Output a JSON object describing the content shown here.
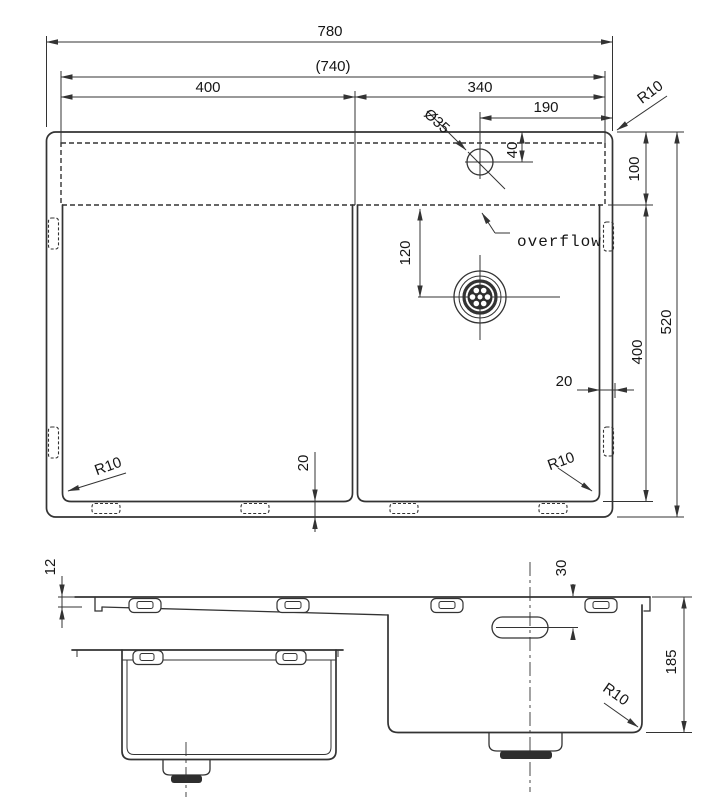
{
  "drawing": {
    "type": "sink technical drawing, plan view and sectional elevation",
    "plan": {
      "width_overall": "780",
      "width_cutout": "(740)",
      "width_left_bowl": "400",
      "width_right_bowl": "340",
      "faucet_from_right": "190",
      "faucet_hole_diameter": "Ø35",
      "faucet_from_top": "40",
      "ledge_height": "100",
      "bowl_height": "400",
      "height_overall": "520",
      "drain_from_ledge": "120",
      "rim_right": "20",
      "rim_bottom": "20",
      "overflow_label": "overflow",
      "radius_top_right": "R10",
      "radius_bottom_left": "R10",
      "radius_bottom_right": "R10"
    },
    "elevation": {
      "rim_thickness": "12",
      "overflow_from_top": "30",
      "bowl_depth": "185",
      "radius_bottom": "R10"
    }
  }
}
